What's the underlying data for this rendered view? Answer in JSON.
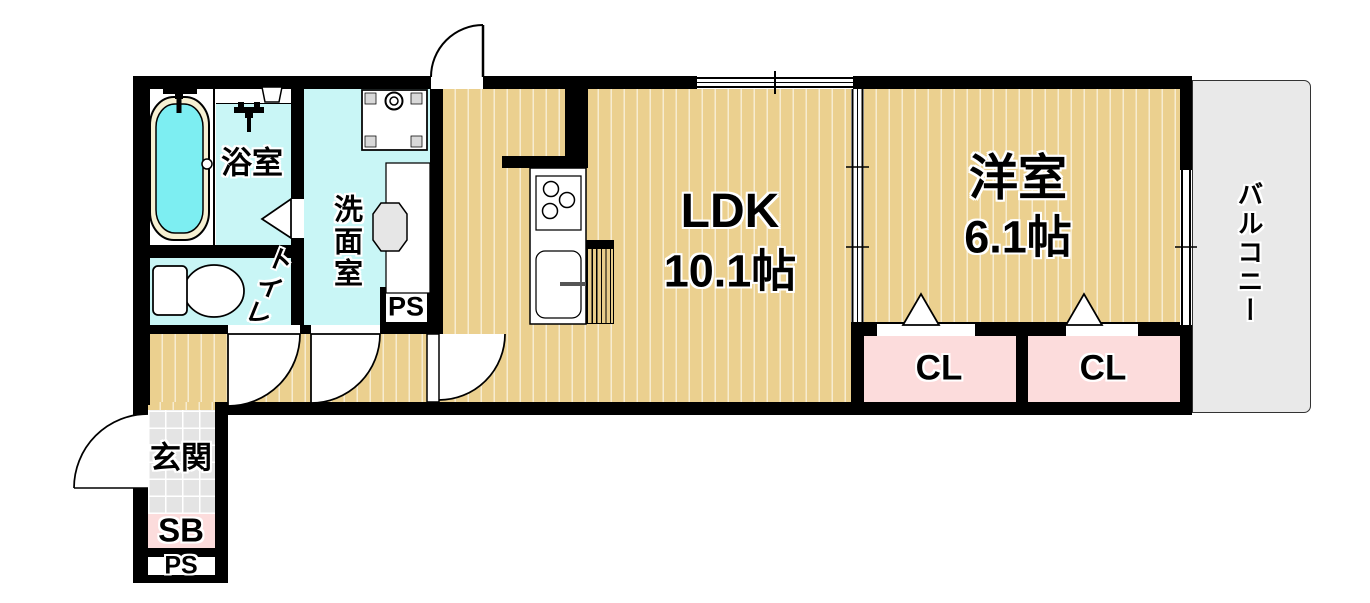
{
  "floorplan": {
    "rooms": {
      "bath": {
        "label": "浴室"
      },
      "washroom": {
        "label": "洗面室"
      },
      "toilet": {
        "label": "トイレ"
      },
      "ldk": {
        "label": "LDK",
        "size": "10.1帖"
      },
      "western_room": {
        "label": "洋室",
        "size": "6.1帖"
      },
      "closet1": {
        "label": "CL"
      },
      "closet2": {
        "label": "CL"
      },
      "balcony": {
        "label": "バルコニー"
      },
      "entrance": {
        "label": "玄関"
      },
      "shoe_box": {
        "label": "SB"
      },
      "pipe_space_upper": {
        "label": "PS"
      },
      "pipe_space_lower": {
        "label": "PS"
      }
    },
    "colors": {
      "wall": "#000000",
      "flooring": "#ebd08f",
      "flooring_stripe": "#f7ecd0",
      "wet_area": "#c9f6f6",
      "bathtub_water": "#7deef2",
      "bathtub_rim": "#f6f0d2",
      "closet": "#fcdcdc",
      "entrance_tile": "#e4e4e4",
      "balcony": "#e9e9e9"
    }
  }
}
